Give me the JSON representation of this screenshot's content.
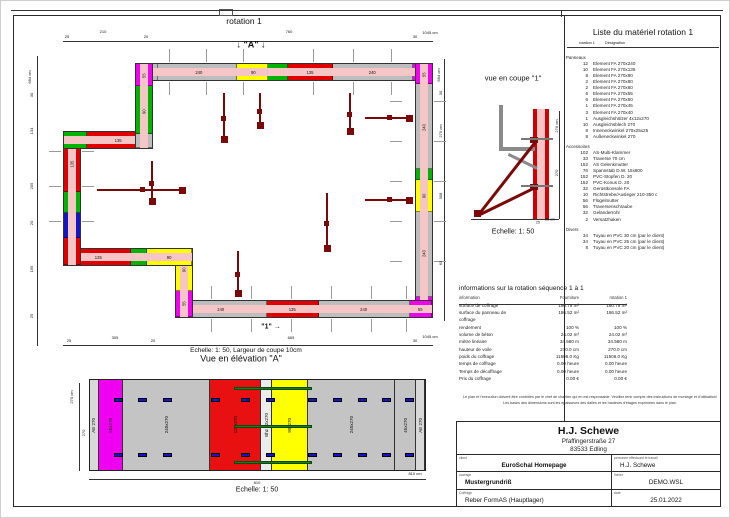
{
  "plan": {
    "title": "rotation 1",
    "walls": [
      {
        "o": "h",
        "x": 140,
        "y": 62,
        "w": 292,
        "h": 18,
        "segments": [
          {
            "w": 45,
            "c": "#bdbdbd",
            "l": "45"
          },
          {
            "w": 240,
            "c": "#bdbdbd",
            "l": "240"
          },
          {
            "w": 90,
            "c": "#ffff00",
            "l": "90"
          },
          {
            "w": 60,
            "c": "#00b400",
            "l": ""
          },
          {
            "w": 135,
            "c": "#e00000",
            "l": "135"
          },
          {
            "w": 240,
            "c": "#bdbdbd",
            "l": "240"
          },
          {
            "w": 55,
            "c": "#f000f0",
            "l": "55"
          }
        ]
      },
      {
        "o": "v",
        "x": 414,
        "y": 62,
        "w": 18,
        "h": 255,
        "segments": [
          {
            "w": 55,
            "c": "#f000f0",
            "l": "55"
          },
          {
            "w": 240,
            "c": "#bdbdbd",
            "l": "240"
          },
          {
            "w": 30,
            "c": "#00b400",
            "l": ""
          },
          {
            "w": 90,
            "c": "#ffff00",
            "l": "90"
          },
          {
            "w": 240,
            "c": "#bdbdbd",
            "l": "240"
          },
          {
            "w": 55,
            "c": "#f000f0",
            "l": "55"
          }
        ]
      },
      {
        "o": "h",
        "x": 174,
        "y": 299,
        "w": 258,
        "h": 18,
        "segments": [
          {
            "w": 240,
            "c": "#bdbdbd",
            "l": "240"
          },
          {
            "w": 135,
            "c": "#e00000",
            "l": "135"
          },
          {
            "w": 240,
            "c": "#bdbdbd",
            "l": "240"
          },
          {
            "w": 55,
            "c": "#f000f0",
            "l": "55"
          }
        ]
      },
      {
        "o": "v",
        "x": 174,
        "y": 247,
        "w": 18,
        "h": 70,
        "segments": [
          {
            "w": 90,
            "c": "#ffff00",
            "l": "90"
          },
          {
            "w": 55,
            "c": "#f000f0",
            "l": "55"
          }
        ]
      },
      {
        "o": "h",
        "x": 62,
        "y": 247,
        "w": 130,
        "h": 18,
        "segments": [
          {
            "w": 135,
            "c": "#e00000",
            "l": "135"
          },
          {
            "w": 30,
            "c": "#00b400",
            "l": ""
          },
          {
            "w": 90,
            "c": "#ffff00",
            "l": "90"
          }
        ]
      },
      {
        "o": "v",
        "x": 62,
        "y": 130,
        "w": 18,
        "h": 135,
        "segments": [
          {
            "w": 135,
            "c": "#e00000",
            "l": "135"
          },
          {
            "w": 45,
            "c": "#00b400",
            "l": ""
          },
          {
            "w": 55,
            "c": "#1414c8",
            "l": ""
          },
          {
            "w": 60,
            "c": "#e00000",
            "l": ""
          }
        ]
      },
      {
        "o": "h",
        "x": 62,
        "y": 130,
        "w": 90,
        "h": 18,
        "segments": [
          {
            "w": 45,
            "c": "#00b400",
            "l": ""
          },
          {
            "w": 135,
            "c": "#e00000",
            "l": "135"
          }
        ]
      },
      {
        "o": "v",
        "x": 134,
        "y": 62,
        "w": 18,
        "h": 86,
        "segments": [
          {
            "w": 40,
            "c": "#f000f0",
            "l": "55"
          },
          {
            "w": 90,
            "c": "#00b400",
            "l": "90"
          },
          {
            "w": 25,
            "c": "#bdbdbd",
            "l": ""
          }
        ]
      }
    ],
    "braces": [
      {
        "d": "v",
        "x": 222,
        "y": 92,
        "len": 46
      },
      {
        "d": "v",
        "x": 258,
        "y": 92,
        "len": 32
      },
      {
        "d": "v",
        "x": 348,
        "y": 92,
        "len": 38
      },
      {
        "d": "h",
        "x": 364,
        "y": 116,
        "len": 44
      },
      {
        "d": "h",
        "x": 364,
        "y": 198,
        "len": 44
      },
      {
        "d": "h",
        "x": 96,
        "y": 188,
        "len": 85
      },
      {
        "d": "v",
        "x": 236,
        "y": 250,
        "len": 42
      },
      {
        "d": "v",
        "x": 325,
        "y": 192,
        "len": 55
      },
      {
        "d": "v",
        "x": 150,
        "y": 160,
        "len": 40
      }
    ],
    "ticks": [
      {
        "d": "v",
        "y": 48,
        "len": 13,
        "xs": [
          168,
          205,
          242,
          312,
          352,
          390
        ]
      },
      {
        "d": "v",
        "y": 81,
        "len": 13,
        "xs": [
          168,
          205,
          242,
          312,
          352,
          390
        ]
      },
      {
        "d": "v",
        "y": 285,
        "len": 13,
        "xs": [
          210,
          250,
          290,
          330,
          370,
          405
        ]
      },
      {
        "d": "v",
        "y": 318,
        "len": 13,
        "xs": [
          210,
          250,
          290,
          330,
          370,
          405
        ]
      },
      {
        "d": "h",
        "x": 433,
        "len": 12,
        "ys": [
          100,
          140,
          180,
          220,
          260
        ]
      },
      {
        "d": "h",
        "x": 389,
        "len": 12,
        "ys": [
          100,
          140,
          180,
          220,
          260
        ]
      },
      {
        "d": "h",
        "x": 48,
        "len": 12,
        "ys": [
          150,
          185,
          220
        ]
      },
      {
        "d": "h",
        "x": 81,
        "len": 12,
        "ys": [
          150,
          185,
          220
        ]
      }
    ]
  },
  "lines": [
    {
      "x": 62,
      "y": 40,
      "w": 370,
      "h": 0.7
    },
    {
      "x": 36,
      "y": 55,
      "w": 0.7,
      "h": 290
    },
    {
      "x": 443,
      "y": 58,
      "w": 0.7,
      "h": 262
    },
    {
      "x": 62,
      "y": 344,
      "w": 370,
      "h": 0.7
    },
    {
      "x": 470,
      "y": 218,
      "w": 88,
      "h": 0.9
    },
    {
      "x": 558,
      "y": 110,
      "w": 0.7,
      "h": 108
    },
    {
      "x": 78,
      "y": 382,
      "w": 0.7,
      "h": 88
    },
    {
      "x": 88,
      "y": 478,
      "w": 337,
      "h": 0.7
    },
    {
      "x": 566,
      "y": 46,
      "w": 152,
      "h": 0.6
    },
    {
      "x": 458,
      "y": 303,
      "w": 168,
      "h": 0.6
    },
    {
      "x": 10,
      "y": 9,
      "w": 712,
      "h": 0.8
    },
    {
      "x": 560,
      "y": 9,
      "w": 0.8,
      "h": 7
    }
  ],
  "annotations": [
    {
      "t": "rotation 1",
      "x": 243,
      "y": 20,
      "s": 8.5
    },
    {
      "t": "↓ \"A\" ↓",
      "x": 250,
      "y": 44,
      "s": 9,
      "b": true
    },
    {
      "t": "25",
      "x": 66,
      "y": 36,
      "s": 4
    },
    {
      "t": "210",
      "x": 102,
      "y": 31,
      "s": 4
    },
    {
      "t": "20",
      "x": 145,
      "y": 36,
      "s": 4
    },
    {
      "t": "760",
      "x": 288,
      "y": 31,
      "s": 4
    },
    {
      "t": "30",
      "x": 414,
      "y": 36,
      "s": 4
    },
    {
      "t": "1045 cm",
      "x": 429,
      "y": 32,
      "s": 4
    },
    {
      "t": "684 cm",
      "x": 29,
      "y": 76,
      "s": 4,
      "r": true
    },
    {
      "t": "30",
      "x": 31,
      "y": 94,
      "s": 4,
      "r": true
    },
    {
      "t": "134",
      "x": 31,
      "y": 130,
      "s": 4,
      "r": true
    },
    {
      "t": "205",
      "x": 31,
      "y": 185,
      "s": 4,
      "r": true
    },
    {
      "t": "20",
      "x": 31,
      "y": 222,
      "s": 4,
      "r": true
    },
    {
      "t": "195",
      "x": 31,
      "y": 268,
      "s": 4,
      "r": true
    },
    {
      "t": "25",
      "x": 31,
      "y": 315,
      "s": 4,
      "r": true
    },
    {
      "t": "684 cm",
      "x": 438,
      "y": 74,
      "s": 4,
      "r": true
    },
    {
      "t": "30",
      "x": 440,
      "y": 92,
      "s": 4,
      "r": true
    },
    {
      "t": "270 cm",
      "x": 440,
      "y": 130,
      "s": 4,
      "r": true
    },
    {
      "t": "358",
      "x": 440,
      "y": 195,
      "s": 4,
      "r": true
    },
    {
      "t": "63",
      "x": 440,
      "y": 262,
      "s": 4,
      "r": true
    },
    {
      "t": "25",
      "x": 68,
      "y": 340,
      "s": 4
    },
    {
      "t": "305",
      "x": 114,
      "y": 337,
      "s": 4
    },
    {
      "t": "20",
      "x": 152,
      "y": 340,
      "s": 4
    },
    {
      "t": "665",
      "x": 290,
      "y": 337,
      "s": 4
    },
    {
      "t": "30",
      "x": 414,
      "y": 340,
      "s": 4
    },
    {
      "t": "1045 cm",
      "x": 429,
      "y": 336,
      "s": 4
    },
    {
      "t": "\"1\" →",
      "x": 270,
      "y": 326,
      "s": 7,
      "b": true
    },
    {
      "t": "Echelle: 1: 50,  Largeur de coupe 10cm",
      "x": 245,
      "y": 350,
      "s": 6.5
    },
    {
      "t": "Vue en élévation \"A\"",
      "x": 240,
      "y": 358,
      "s": 9
    },
    {
      "t": "270 cm",
      "x": 71,
      "y": 396,
      "s": 4,
      "r": true
    },
    {
      "t": "270",
      "x": 83,
      "y": 432,
      "s": 4,
      "r": true
    },
    {
      "t": "810",
      "x": 256,
      "y": 482,
      "s": 4
    },
    {
      "t": "810 cm",
      "x": 414,
      "y": 473,
      "s": 4
    },
    {
      "t": "Echelle: 1: 50",
      "x": 256,
      "y": 489,
      "s": 7
    },
    {
      "t": "vue en coupe \"1\"",
      "x": 512,
      "y": 77,
      "s": 7.5
    },
    {
      "t": "270 cm",
      "x": 556,
      "y": 125,
      "s": 4,
      "r": true
    },
    {
      "t": "270",
      "x": 556,
      "y": 172,
      "s": 4,
      "r": true
    },
    {
      "t": "25",
      "x": 537,
      "y": 222,
      "s": 3.5
    },
    {
      "t": "25 cm",
      "x": 549,
      "y": 219,
      "s": 3.5
    },
    {
      "t": "Echelle: 1: 50",
      "x": 512,
      "y": 231,
      "s": 7
    },
    {
      "t": "Liste du matériel  rotation 1",
      "x": 642,
      "y": 31,
      "s": 8.5
    },
    {
      "t": "rotation 1",
      "x": 586,
      "y": 43,
      "s": 3.8
    },
    {
      "t": "Désignation",
      "x": 614,
      "y": 43,
      "s": 3.8
    }
  ],
  "materials": {
    "title": "Liste du matériel  rotation 1",
    "col_headers": [
      "rotation 1",
      "Désignation"
    ],
    "groups": [
      {
        "name": "Panneaux",
        "items": [
          {
            "qty": "12",
            "name": "Element FA 270x240"
          },
          {
            "qty": "10",
            "name": "Element FA 270x135"
          },
          {
            "qty": "8",
            "name": "Element FA 270x90"
          },
          {
            "qty": "2",
            "name": "Element FA 270x80"
          },
          {
            "qty": "2",
            "name": "Element FA 270x60"
          },
          {
            "qty": "6",
            "name": "Element FA 270x55"
          },
          {
            "qty": "6",
            "name": "Element FA 270x50"
          },
          {
            "qty": "1",
            "name": "Element FA 270x45"
          },
          {
            "qty": "3",
            "name": "Element FA 270x40"
          },
          {
            "qty": "1",
            "name": "Ausgleichshölzer 4x12x270"
          },
          {
            "qty": "10",
            "name": "Ausgleichsblech 270"
          },
          {
            "qty": "8",
            "name": "Inneneckwinkel 270x25x25"
          },
          {
            "qty": "8",
            "name": "Außeneckwinkel 270"
          }
        ]
      },
      {
        "name": "Accessoires",
        "items": [
          {
            "qty": "102",
            "name": "AS-Multi-Klammer"
          },
          {
            "qty": "33",
            "name": "Traverse 70 cm"
          },
          {
            "qty": "152",
            "name": "AS Gelenkmutter"
          },
          {
            "qty": "76",
            "name": "Spannstab D.W. 15x800"
          },
          {
            "qty": "152",
            "name": "PVC-Stopfen D. 20"
          },
          {
            "qty": "152",
            "name": "PVC-Konus D. 20"
          },
          {
            "qty": "32",
            "name": "Gerüstkonsole FA"
          },
          {
            "qty": "10",
            "name": "Richtstrebe/Ausleger 210-350 c"
          },
          {
            "qty": "56",
            "name": "Flügelmutter"
          },
          {
            "qty": "56",
            "name": "Traversenschraube"
          },
          {
            "qty": "32",
            "name": "Geländerrohr"
          },
          {
            "qty": "2",
            "name": "Versatzhaken"
          }
        ]
      },
      {
        "name": "Divers",
        "items": [
          {
            "qty": "34",
            "name": "Tuyau en PVC 30 cm (par le client)"
          },
          {
            "qty": "34",
            "name": "Tuyau en PVC 25 cm (par le client)"
          },
          {
            "qty": "8",
            "name": "Tuyau en PVC 20 cm (par le client)"
          }
        ]
      }
    ]
  },
  "info_table": {
    "title": "informations sur la rotation  séquence 1 à 1",
    "headers": [
      "information",
      "Fourniture",
      "rotation 1"
    ],
    "rows": [
      [
        "surface de coffrage",
        "180.79 m²",
        "180.79 m²"
      ],
      [
        "surface du panneau de coffrage",
        "186.52 m²",
        "186.52 m²"
      ],
      [
        "rendement",
        "100 %",
        "100 %"
      ],
      [
        "volume de béton",
        "24.02 m³",
        "24.02 m³"
      ],
      [
        "mètre linéaire",
        "34.580 m",
        "34.580 m"
      ],
      [
        "hauteur de voile",
        "270.0 cm",
        "270.0 cm"
      ],
      [
        "poids du coffrage",
        "11506.0 Kg",
        "11506.0 Kg"
      ],
      [
        "temps de coffrage",
        "0.00 heure",
        "0.00 heure"
      ],
      [
        "Temps de décoffrage",
        "0.00 heure",
        "0.00 heure"
      ],
      [
        "Prix du coffrage",
        "0.00 €",
        "0.00 €"
      ]
    ]
  },
  "notes": [
    "Le plan et l'exécution doivent être contrôlés par le chef de chantier qui en est responsable. Veuillez tenir compte des instructions de montage et d'utilisation!",
    "Les bases des dimensions sont les épaisseurs des dalles et les hauteurs d'étages exprimées dans le plan."
  ],
  "title_block": {
    "company": "H.J. Schewe",
    "address1": "Pfaffingerstraße 27",
    "address2": "83533 Edling",
    "client_label": "client",
    "client": "EuroSchal Homepage",
    "worker_label": "personne effectuant le travail",
    "worker": "H.J. Schewe",
    "project_label": "ouvrage",
    "project": "Mustergrundriß",
    "file_label": "fichier",
    "file": "DEMO.WSL",
    "formwork_label": "Coffrage",
    "formwork": "Reber FormAS (Hauptlager)",
    "date_label": "date",
    "date": "25.01.2022"
  },
  "elevation": {
    "panels": [
      {
        "label": "AE 270",
        "color": "#d8d8d8",
        "w": 8
      },
      {
        "label": "55x270",
        "color": "#f000f0",
        "w": 55
      },
      {
        "label": "240x270",
        "color": "#c4c4c4",
        "w": 240
      },
      {
        "label": "135x270",
        "color": "#e81010",
        "w": 135
      },
      {
        "label": "Bhz 12x270",
        "color": "#ececec",
        "w": 14
      },
      {
        "label": "90x270",
        "color": "#ffff00",
        "w": 90
      },
      {
        "label": "240x270",
        "color": "#c4c4c4",
        "w": 240
      },
      {
        "label": "45x270",
        "color": "#c4c4c4",
        "w": 45
      },
      {
        "label": "AE 270",
        "color": "#d8d8d8",
        "w": 8
      }
    ],
    "clamp_xs": [
      113,
      137,
      162,
      210,
      240,
      265,
      307,
      332,
      357,
      381,
      404
    ],
    "clamp_ys": [
      397,
      452
    ],
    "ties": [
      {
        "x": 233,
        "y": 386,
        "w": 78
      },
      {
        "x": 233,
        "y": 424,
        "w": 78
      },
      {
        "x": 233,
        "y": 460,
        "w": 78
      }
    ]
  }
}
